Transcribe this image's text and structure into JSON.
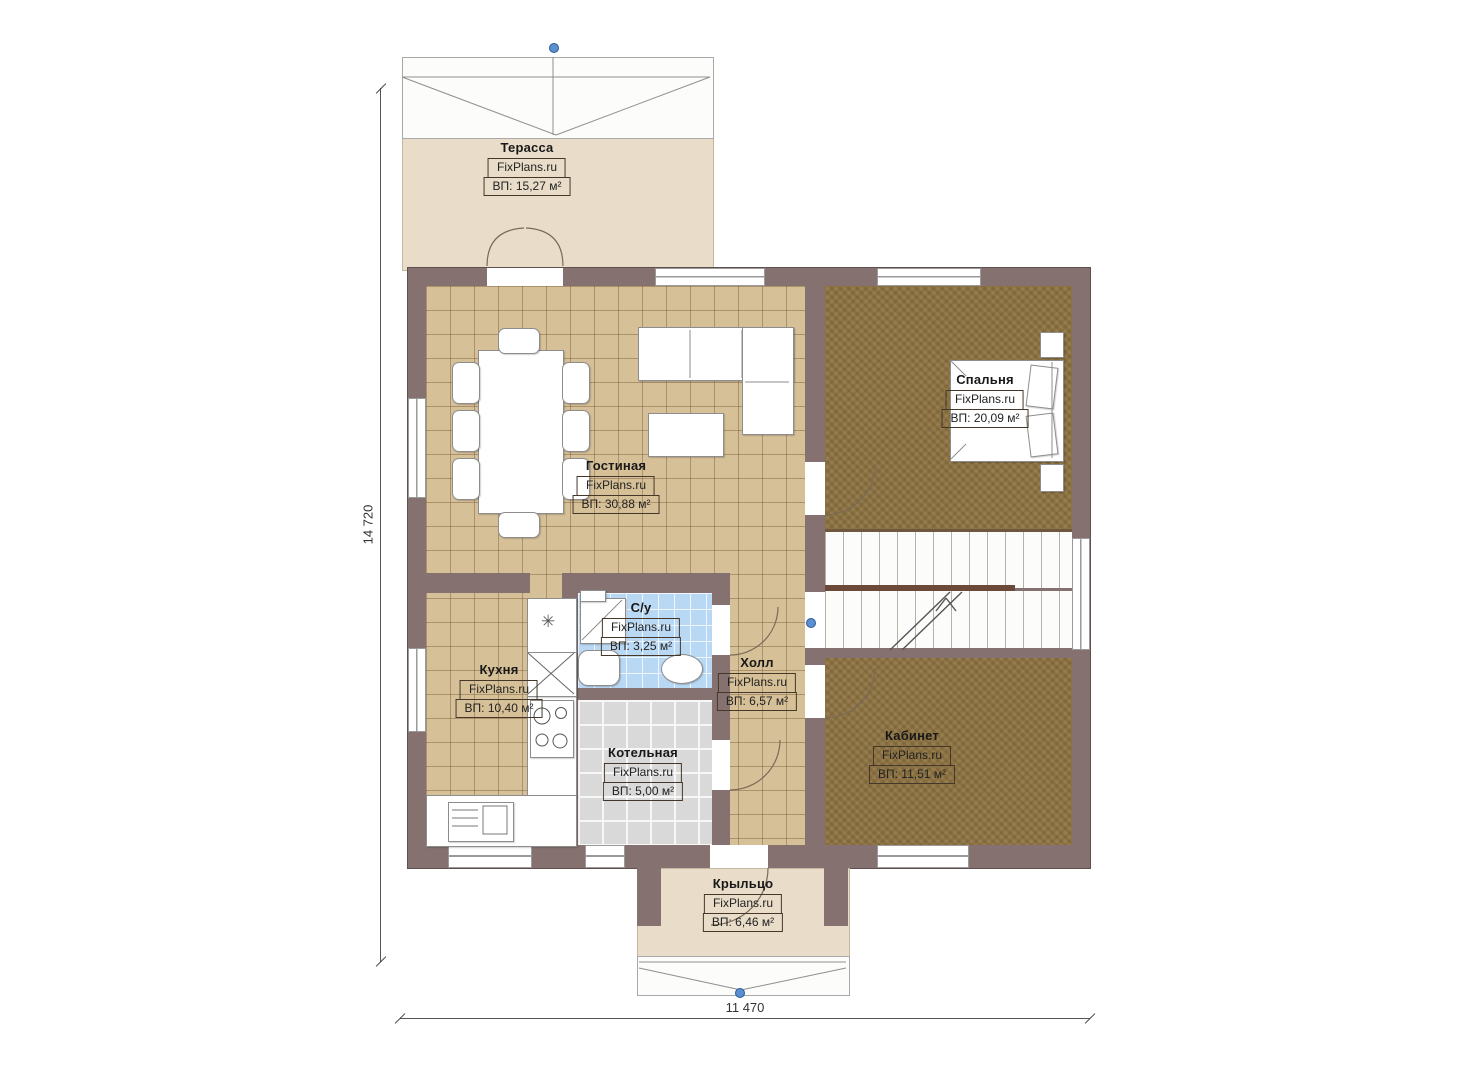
{
  "plan": {
    "brand": "FixPlans.ru",
    "dimensions": {
      "vertical": "14 720",
      "horizontal": "11 470"
    },
    "rooms": {
      "terrace": {
        "name": "Терасса",
        "area": "ВП: 15,27 м²"
      },
      "living": {
        "name": "Гостиная",
        "area": "ВП: 30,88 м²"
      },
      "bedroom": {
        "name": "Спальня",
        "area": "ВП: 20,09 м²"
      },
      "bathroom": {
        "name": "С/у",
        "area": "ВП: 3,25 м²"
      },
      "kitchen": {
        "name": "Кухня",
        "area": "ВП: 10,40 м²"
      },
      "hall": {
        "name": "Холл",
        "area": "ВП: 6,57 м²"
      },
      "boiler": {
        "name": "Котельная",
        "area": "ВП: 5,00 м²"
      },
      "office": {
        "name": "Кабинет",
        "area": "ВП: 11,51 м²"
      },
      "porch": {
        "name": "Крыльцо",
        "area": "ВП: 6,46 м²"
      }
    },
    "icons": {
      "sink_symbol": "✳"
    },
    "colors": {
      "wall": "#857270",
      "tile_floor": "#d6c098",
      "carpet_floor": "#8d7343",
      "boiler_floor": "#d9d9d9",
      "bath_floor": "#b9d8f3",
      "terrace_floor": "#e9ddc9",
      "marker_blue": "#5b8fd0"
    }
  }
}
